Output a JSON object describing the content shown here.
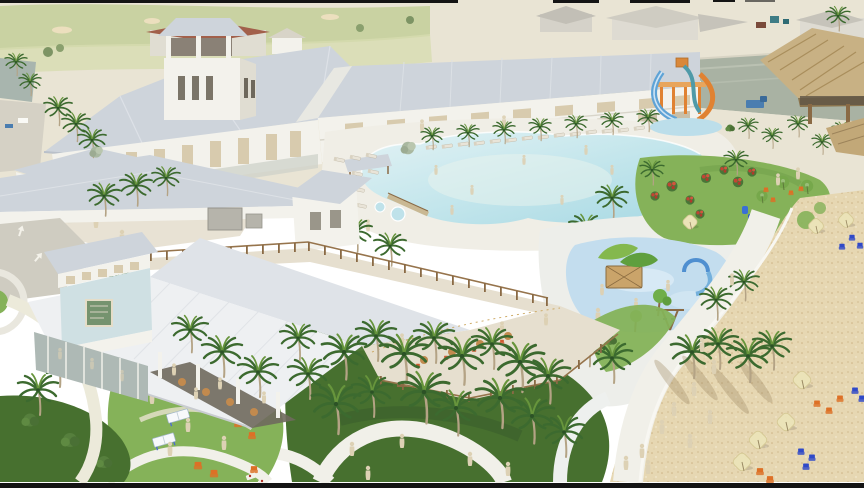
{
  "meta": {
    "description": "Aerial 3D architectural rendering of a coastal resort: a large white clubhouse with cupola tower and a long two-story hotel wing behind a freeform lagoon pool lined with loungers; water slides, a thatched palapa bar and marina channel at top right; a splash pad and playground, event lawns with red flowering shrubs, a restaurant pavilion with light-blue signage tower and boardwalk in the foreground; winding white paths through palm gardens leading to a sandy beach with cream umbrellas and orange and blue adirondack chairs; untextured beige ghost figures populate the scene"
  },
  "palette": {
    "frame": "#141414",
    "ground": "#e9e4d4",
    "golf": "#c9d2a2",
    "golf2": "#d7dcb0",
    "pond": "#a8b5ae",
    "channel": "#a9b2a3",
    "roof-l": "#dfe3e8",
    "roof-m": "#ced4db",
    "roof-d": "#b9c0c9",
    "wall": "#f3f2ec",
    "wall-s": "#e0ddd2",
    "tan": "#d8cbae",
    "open": "#c8bfa8",
    "deck": "#f0eee6",
    "deck2": "#e6dfcf",
    "pool-l": "#ddf0f2",
    "pool-d": "#a6d8e3",
    "pool-sand": "#e9f3ee",
    "splash": "#c3ddee",
    "lawn": "#85b259",
    "lawn-d": "#5f8f3f",
    "hedge": "#47702f",
    "path": "#f1f0e9",
    "road": "#cfccc1",
    "sand": "#e6d7b2",
    "sand-dot": "#c9ac7e",
    "thatch": "#c8b184",
    "thatch-d": "#a98e5c",
    "trunk": "#b4a385",
    "frond": "#3c6a2f",
    "frond-l": "#67953c",
    "ghost": "#ddd1b4",
    "lounger": "#e9e4d8",
    "umb-cream": "#ebe3b8",
    "umb-green": "#76a84b",
    "chair-orange": "#dd7026",
    "chair-blue": "#2f49c8",
    "slide-blue": "#5ea3d6",
    "slide-orange": "#e08232",
    "play-green": "#84b84e",
    "tower-blue": "#cfe0e3",
    "sign-green": "#75936f",
    "flower": "#c24434",
    "dark": "#6f695d",
    "wood": "#8a6a45",
    "ac": "#b6b4ab",
    "truck": "#4a7db0"
  },
  "scene": {
    "areas": [
      "golf-course",
      "marina-channel",
      "distant-buildings",
      "clubhouse",
      "hotel-wing",
      "lagoon-pool",
      "pool-deck",
      "water-slides",
      "palapa-bar",
      "splash-pad",
      "playground",
      "event-lawn",
      "restaurant-pavilion",
      "boardwalk",
      "beach",
      "palm-gardens",
      "walking-paths",
      "rear-service-road"
    ]
  }
}
